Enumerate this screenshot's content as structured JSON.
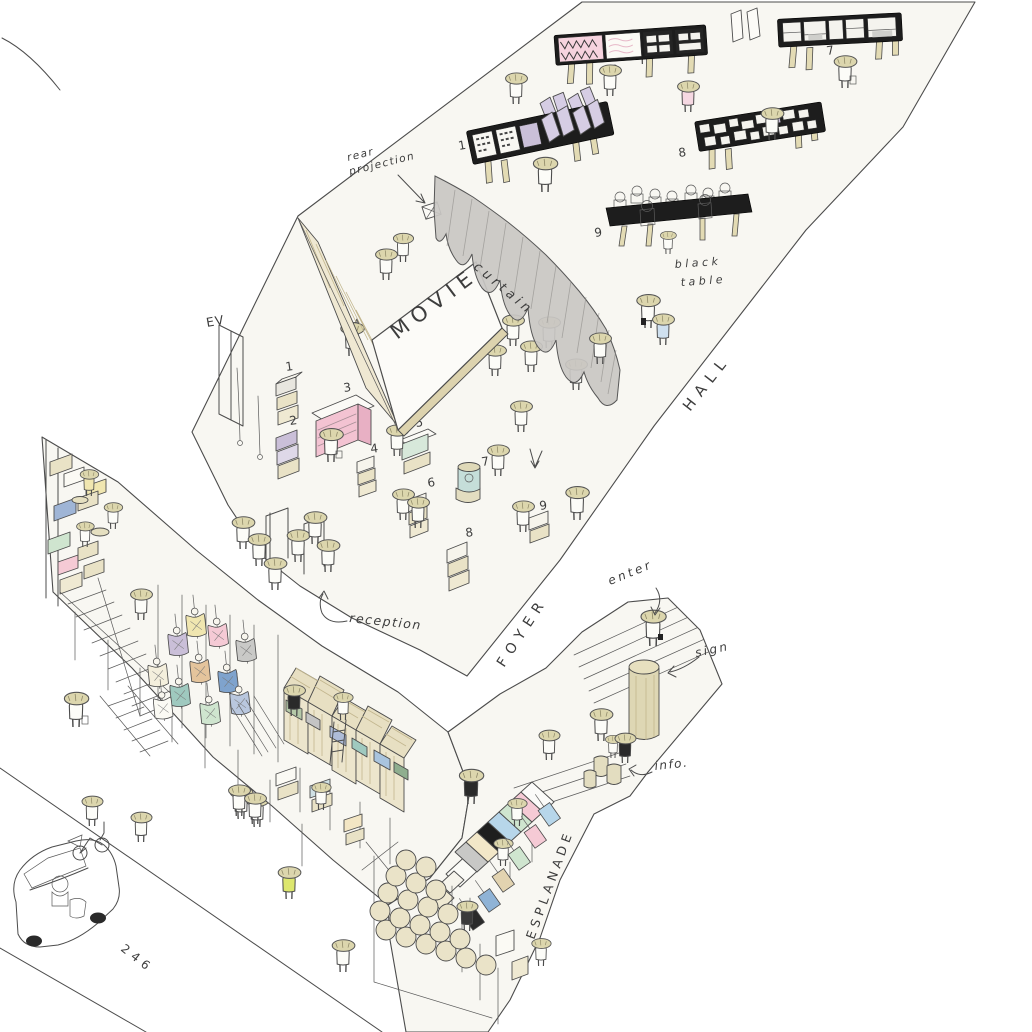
{
  "areas": {
    "hall": "HALL",
    "foyer": "FOYER",
    "esplanade": "ESPLANADE"
  },
  "annotations": {
    "rear_projection_l1": "rear",
    "rear_projection_l2": "projection",
    "movie": "MOVIE",
    "curtain": "curtain",
    "black_table_l1": "black",
    "black_table_l2": "table",
    "ev": "EV",
    "reception": "reception",
    "enter": "enter",
    "sign": "sign",
    "info": "info.",
    "route": "246"
  },
  "hall_exhibits": {
    "wall_1": "1",
    "wall_2": "2",
    "wall_7": "7",
    "wall_8": "8",
    "table_9": "9"
  },
  "foyer_stands": {
    "s1": "1",
    "s2": "2",
    "s3": "3",
    "s4": "4",
    "s5": "5",
    "s6": "6",
    "s7": "7",
    "s8": "8",
    "s9": "9"
  },
  "colors": {
    "paper": "#f8f7f2",
    "ink": "#4c4c4c",
    "wall_black": "#1d1d1d",
    "pink": "#f5cad5",
    "lavender": "#cabfd8",
    "mint": "#cfe5cf",
    "blue": "#b7d6ea",
    "teal": "#9fc9bf",
    "beige": "#e9e2c6",
    "hat": "#dcd6ad",
    "curtain_gray": "#c9c7c3"
  }
}
